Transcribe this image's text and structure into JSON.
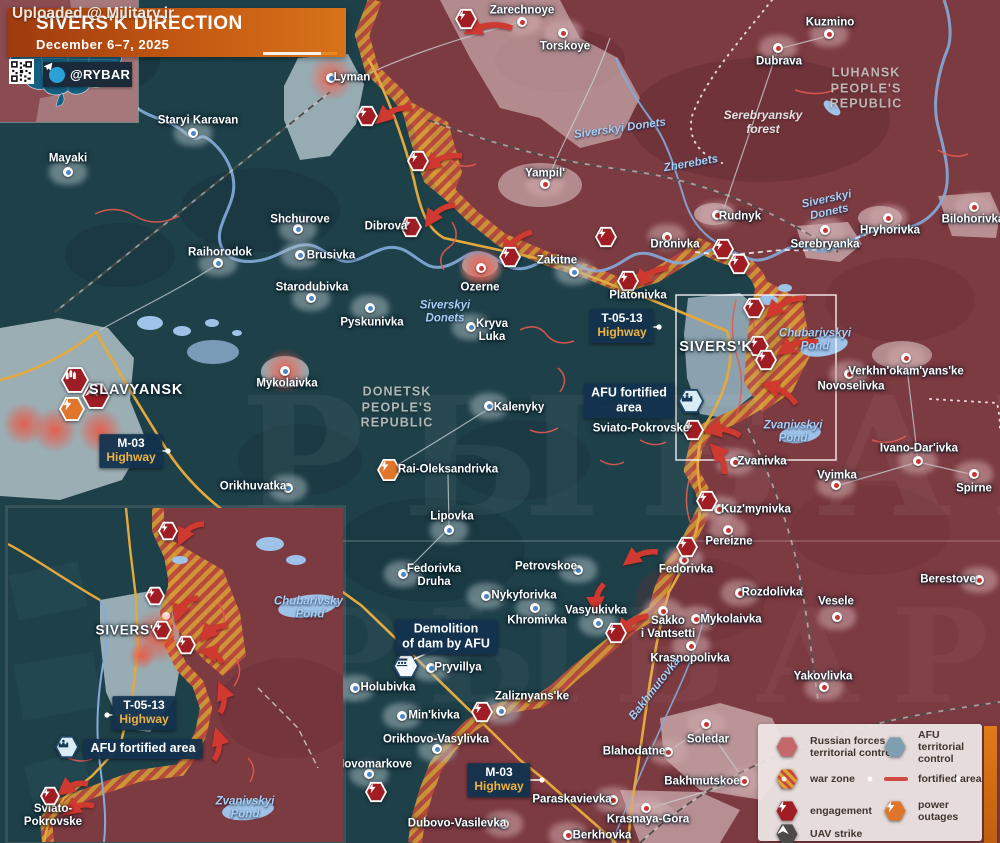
{
  "watermark_top": "Uploaded @ Military.ir",
  "big_watermark": "РЫБАРЬ",
  "header": {
    "title": "SIVERS'K DIRECTION",
    "date": "December 6–7, 2025",
    "channel": "@RYBAR"
  },
  "colors": {
    "banner_orange": "#c55a12",
    "navy_box": "#12314e",
    "engagement_red": "#a01d24",
    "power_orange": "#e0762b",
    "uav_gray": "#4d4a47",
    "russian_zone": "#7c3a41",
    "afu_zone": "#1e4049",
    "warzone_orange": "#d69a35",
    "warzone_red": "#bc4b3d",
    "telegram_blue": "#2aa2d8",
    "road_yellow": "#e3a93d",
    "river_blue": "#84abdb",
    "fortified_line": "#e4594e",
    "highway_text_yellow": "#efb23e"
  },
  "region_labels": [
    {
      "t": "LUHANSK\nPEOPLE'S\nREPUBLIC",
      "x": 866,
      "y": 89
    },
    {
      "t": "DONETSK\nPEOPLE'S\nREPUBLIC",
      "x": 397,
      "y": 408
    }
  ],
  "forest_labels": [
    {
      "t": "Serebryansky\nforest",
      "x": 763,
      "y": 123
    }
  ],
  "water_labels": [
    {
      "t": "Siverskyi Donets",
      "x": 620,
      "y": 129,
      "rot": -8
    },
    {
      "t": "Zherebets",
      "x": 691,
      "y": 164,
      "rot": -10
    },
    {
      "t": "Siverskyi\nDonets",
      "x": 828,
      "y": 206,
      "rot": -12
    },
    {
      "t": "Siverskyi\nDonets",
      "x": 445,
      "y": 312,
      "rot": 0
    },
    {
      "t": "Chubarivskyi\nPond",
      "x": 815,
      "y": 340,
      "rot": 0
    },
    {
      "t": "Zvanivskyi\nPond",
      "x": 793,
      "y": 432,
      "rot": 0
    },
    {
      "t": "Bakhmutovka",
      "x": 655,
      "y": 689,
      "rot": -52
    }
  ],
  "main_map": {
    "towns": [
      {
        "n": "Lyman",
        "lx": 352,
        "ly": 78,
        "dx": 331,
        "dy": 78,
        "z": "ua",
        "glow": true
      },
      {
        "n": "Zarechnoye",
        "lx": 522,
        "ly": 11,
        "dx": 522,
        "dy": 22,
        "z": "ru"
      },
      {
        "n": "Torskoye",
        "lx": 565,
        "ly": 47,
        "dx": 563,
        "dy": 33,
        "z": "ru"
      },
      {
        "n": "Kuzmino",
        "lx": 830,
        "ly": 23,
        "dx": 829,
        "dy": 34,
        "z": "ru"
      },
      {
        "n": "Dubrava",
        "lx": 779,
        "ly": 62,
        "dx": 778,
        "dy": 48,
        "z": "ru"
      },
      {
        "n": "Yampil'",
        "lx": 545,
        "ly": 174,
        "dx": 545,
        "dy": 184,
        "z": "ru"
      },
      {
        "n": "Rudnyk",
        "lx": 740,
        "ly": 217,
        "dx": 717,
        "dy": 215,
        "z": "ru"
      },
      {
        "n": "Serebryanka",
        "lx": 825,
        "ly": 245,
        "dx": 825,
        "dy": 230,
        "z": "ru"
      },
      {
        "n": "Hryhorivka",
        "lx": 890,
        "ly": 231,
        "dx": 888,
        "dy": 218,
        "z": "ru"
      },
      {
        "n": "Bilohorivka",
        "lx": 973,
        "ly": 220,
        "dx": 974,
        "dy": 207,
        "z": "ru"
      },
      {
        "n": "Mayaki",
        "lx": 68,
        "ly": 159,
        "dx": 68,
        "dy": 172,
        "z": "ua"
      },
      {
        "n": "Staryi Karavan",
        "lx": 198,
        "ly": 121,
        "dx": 193,
        "dy": 133,
        "z": "ua"
      },
      {
        "n": "Shchurove",
        "lx": 300,
        "ly": 220,
        "dx": 298,
        "dy": 229,
        "z": "ua"
      },
      {
        "n": "Brusivka",
        "lx": 331,
        "ly": 256,
        "dx": 300,
        "dy": 255,
        "z": "ua"
      },
      {
        "n": "Raihorodok",
        "lx": 220,
        "ly": 253,
        "dx": 218,
        "dy": 263,
        "z": "ua"
      },
      {
        "n": "Starodubivka",
        "lx": 312,
        "ly": 288,
        "dx": 311,
        "dy": 298,
        "z": "ua"
      },
      {
        "n": "Pyskunivka",
        "lx": 372,
        "ly": 323,
        "dx": 370,
        "dy": 308,
        "z": "ua"
      },
      {
        "n": "Dibrova",
        "lx": 386,
        "ly": 227,
        "z": "ua"
      },
      {
        "n": "Ozerne",
        "lx": 480,
        "ly": 288,
        "dx": 481,
        "dy": 268,
        "z": "ru",
        "glow": true
      },
      {
        "n": "Zakitne",
        "lx": 557,
        "ly": 261,
        "dx": 574,
        "dy": 272,
        "z": "ua"
      },
      {
        "n": "Kryva\nLuka",
        "lx": 492,
        "ly": 331,
        "dx": 471,
        "dy": 327,
        "z": "ua"
      },
      {
        "n": "Mykolaivka",
        "lx": 287,
        "ly": 384,
        "dx": 285,
        "dy": 371,
        "z": "ua",
        "glow": true
      },
      {
        "n": "Orikhuvatka",
        "lx": 253,
        "ly": 487,
        "dx": 288,
        "dy": 488,
        "z": "ua"
      },
      {
        "n": "Dronivka",
        "lx": 675,
        "ly": 245,
        "dx": 667,
        "dy": 237,
        "z": "ru"
      },
      {
        "n": "Platonivka",
        "lx": 638,
        "ly": 296,
        "z": "ru"
      },
      {
        "n": "SIVERS'K",
        "lx": 716,
        "ly": 347,
        "z": "ua",
        "big": true
      },
      {
        "n": "Sviato-Pokrovske",
        "lx": 641,
        "ly": 429,
        "z": "ua"
      },
      {
        "n": "Novoselivka",
        "lx": 851,
        "ly": 387,
        "dx": 849,
        "dy": 374,
        "z": "ru"
      },
      {
        "n": "Verkhn'okam'yans'ke",
        "lx": 906,
        "ly": 372,
        "dx": 906,
        "dy": 358,
        "z": "ru"
      },
      {
        "n": "Ivano-Dar'ivka",
        "lx": 919,
        "ly": 449,
        "dx": 918,
        "dy": 461,
        "z": "ru"
      },
      {
        "n": "Vyimka",
        "lx": 837,
        "ly": 476,
        "dx": 836,
        "dy": 485,
        "z": "ru"
      },
      {
        "n": "Spirne",
        "lx": 974,
        "ly": 489,
        "dx": 974,
        "dy": 474,
        "z": "ru"
      },
      {
        "n": "Berestove",
        "lx": 948,
        "ly": 580,
        "dx": 979,
        "dy": 580,
        "z": "ru"
      },
      {
        "n": "Vesele",
        "lx": 836,
        "ly": 602,
        "dx": 837,
        "dy": 617,
        "z": "ru"
      },
      {
        "n": "Zvanivka",
        "lx": 762,
        "ly": 462,
        "dx": 735,
        "dy": 462,
        "z": "ru"
      },
      {
        "n": "Kuz'mynivka",
        "lx": 756,
        "ly": 510,
        "dx": 719,
        "dy": 509,
        "z": "ru"
      },
      {
        "n": "Pereizne",
        "lx": 729,
        "ly": 542,
        "dx": 728,
        "dy": 530,
        "z": "ru"
      },
      {
        "n": "Fedorivka",
        "lx": 686,
        "ly": 570,
        "dx": 684,
        "dy": 560,
        "z": "ru"
      },
      {
        "n": "Rozdolivka",
        "lx": 772,
        "ly": 593,
        "dx": 740,
        "dy": 593,
        "z": "ru"
      },
      {
        "n": "Sakko\ni Vantsetti",
        "lx": 668,
        "ly": 628,
        "dx": 663,
        "dy": 611,
        "z": "ru"
      },
      {
        "n": "Mykolaivka",
        "lx": 731,
        "ly": 620,
        "dx": 696,
        "dy": 619,
        "z": "ru"
      },
      {
        "n": "Krasnopolivka",
        "lx": 690,
        "ly": 659,
        "dx": 691,
        "dy": 646,
        "z": "ru"
      },
      {
        "n": "Yakovlivka",
        "lx": 823,
        "ly": 677,
        "dx": 824,
        "dy": 687,
        "z": "ru"
      },
      {
        "n": "Kalenyky",
        "lx": 519,
        "ly": 408,
        "dx": 489,
        "dy": 406,
        "z": "ua"
      },
      {
        "n": "Rai-Oleksandrivka",
        "lx": 448,
        "ly": 470,
        "z": "ua"
      },
      {
        "n": "Lipovka",
        "lx": 452,
        "ly": 517,
        "dx": 449,
        "dy": 530,
        "z": "ua"
      },
      {
        "n": "Fedorivka\nDruha",
        "lx": 434,
        "ly": 576,
        "dx": 403,
        "dy": 574,
        "z": "ua"
      },
      {
        "n": "Petrovskoe",
        "lx": 546,
        "ly": 567,
        "dx": 578,
        "dy": 570,
        "z": "ua"
      },
      {
        "n": "Nykyforivka",
        "lx": 524,
        "ly": 596,
        "dx": 486,
        "dy": 596,
        "z": "ua"
      },
      {
        "n": "Vasyukivka",
        "lx": 596,
        "ly": 611,
        "dx": 598,
        "dy": 623,
        "z": "ua"
      },
      {
        "n": "Khromivka",
        "lx": 537,
        "ly": 621,
        "dx": 535,
        "dy": 608,
        "z": "ua"
      },
      {
        "n": "Holubivka",
        "lx": 388,
        "ly": 688,
        "dx": 355,
        "dy": 688,
        "z": "ua"
      },
      {
        "n": "Pryvillya",
        "lx": 458,
        "ly": 668,
        "dx": 431,
        "dy": 668,
        "z": "ua"
      },
      {
        "n": "Min'kivka",
        "lx": 434,
        "ly": 716,
        "dx": 402,
        "dy": 716,
        "z": "ua"
      },
      {
        "n": "Orikhovo-Vasylivka",
        "lx": 436,
        "ly": 740,
        "dx": 437,
        "dy": 749,
        "z": "ua"
      },
      {
        "n": "Novomarkove",
        "lx": 374,
        "ly": 765,
        "dx": 369,
        "dy": 774,
        "z": "ua"
      },
      {
        "n": "Zaliznyans'ke",
        "lx": 532,
        "ly": 697,
        "dx": 501,
        "dy": 711,
        "z": "ua"
      },
      {
        "n": "Blahodatne",
        "lx": 634,
        "ly": 752,
        "dx": 668,
        "dy": 752,
        "z": "ru"
      },
      {
        "n": "Soledar",
        "lx": 708,
        "ly": 740,
        "dx": 706,
        "dy": 724,
        "z": "ru"
      },
      {
        "n": "Bakhmutskoe",
        "lx": 702,
        "ly": 782,
        "dx": 744,
        "dy": 781,
        "z": "ru"
      },
      {
        "n": "Paraskavievka",
        "lx": 572,
        "ly": 800,
        "dx": 613,
        "dy": 800,
        "z": "ru"
      },
      {
        "n": "Krasnaya-Gora",
        "lx": 648,
        "ly": 820,
        "dx": 646,
        "dy": 808,
        "z": "ru"
      },
      {
        "n": "Berkhovka",
        "lx": 602,
        "ly": 836,
        "dx": 568,
        "dy": 835,
        "z": "ru"
      },
      {
        "n": "Dubovo-Vasilevka",
        "lx": 457,
        "ly": 824,
        "dx": 504,
        "dy": 824,
        "z": "ru"
      },
      {
        "n": "SLAVYANSK",
        "lx": 136,
        "ly": 390,
        "z": "ua",
        "big": true
      }
    ],
    "glows": [
      {
        "x": 24,
        "y": 424,
        "s": 44
      },
      {
        "x": 55,
        "y": 430,
        "s": 46
      },
      {
        "x": 100,
        "y": 431,
        "s": 46
      }
    ],
    "icons": [
      {
        "t": "missile-strike",
        "x": 75,
        "y": 380,
        "s": 28
      },
      {
        "t": "air-strike",
        "x": 96,
        "y": 396,
        "s": 28
      },
      {
        "t": "power-outage",
        "x": 72,
        "y": 409,
        "s": 26
      },
      {
        "t": "power-outage",
        "x": 389,
        "y": 470,
        "s": 24
      },
      {
        "t": "engagement",
        "x": 466,
        "y": 19,
        "s": 22
      },
      {
        "t": "engagement",
        "x": 367,
        "y": 116,
        "s": 22
      },
      {
        "t": "engagement",
        "x": 418,
        "y": 161,
        "s": 22
      },
      {
        "t": "engagement",
        "x": 411,
        "y": 227,
        "s": 22
      },
      {
        "t": "engagement",
        "x": 510,
        "y": 257,
        "s": 22
      },
      {
        "t": "engagement",
        "x": 606,
        "y": 237,
        "s": 22
      },
      {
        "t": "engagement",
        "x": 723,
        "y": 249,
        "s": 22
      },
      {
        "t": "engagement",
        "x": 739,
        "y": 264,
        "s": 22
      },
      {
        "t": "engagement",
        "x": 628,
        "y": 281,
        "s": 22
      },
      {
        "t": "engagement",
        "x": 754,
        "y": 308,
        "s": 22
      },
      {
        "t": "engagement",
        "x": 758,
        "y": 346,
        "s": 22
      },
      {
        "t": "engagement",
        "x": 766,
        "y": 360,
        "s": 22
      },
      {
        "t": "engagement",
        "x": 693,
        "y": 430,
        "s": 22
      },
      {
        "t": "engagement",
        "x": 707,
        "y": 501,
        "s": 22
      },
      {
        "t": "engagement",
        "x": 687,
        "y": 547,
        "s": 22
      },
      {
        "t": "engagement",
        "x": 616,
        "y": 633,
        "s": 22
      },
      {
        "t": "engagement",
        "x": 482,
        "y": 712,
        "s": 22
      },
      {
        "t": "engagement",
        "x": 376,
        "y": 792,
        "s": 22
      },
      {
        "t": "afu-fort",
        "x": 691,
        "y": 401,
        "s": 26
      },
      {
        "t": "dam",
        "x": 406,
        "y": 666,
        "s": 26
      }
    ],
    "attack_arrows": [
      {
        "x1": 512,
        "y1": 28,
        "x2": 472,
        "y2": 30,
        "b": 8
      },
      {
        "x1": 412,
        "y1": 108,
        "x2": 382,
        "y2": 118,
        "b": 7
      },
      {
        "x1": 462,
        "y1": 156,
        "x2": 430,
        "y2": 165,
        "b": 7
      },
      {
        "x1": 455,
        "y1": 205,
        "x2": 430,
        "y2": 220,
        "b": 7
      },
      {
        "x1": 532,
        "y1": 232,
        "x2": 507,
        "y2": 250,
        "b": 6
      },
      {
        "x1": 668,
        "y1": 268,
        "x2": 640,
        "y2": 281,
        "b": 6
      },
      {
        "x1": 806,
        "y1": 298,
        "x2": 772,
        "y2": 312,
        "b": 8
      },
      {
        "x1": 818,
        "y1": 342,
        "x2": 784,
        "y2": 350,
        "b": 7
      },
      {
        "x1": 796,
        "y1": 404,
        "x2": 770,
        "y2": 386,
        "b": 6
      },
      {
        "x1": 740,
        "y1": 436,
        "x2": 712,
        "y2": 430,
        "b": 6
      },
      {
        "x1": 724,
        "y1": 474,
        "x2": 716,
        "y2": 450,
        "b": 6
      },
      {
        "x1": 658,
        "y1": 552,
        "x2": 630,
        "y2": 560,
        "b": 6
      },
      {
        "x1": 604,
        "y1": 584,
        "x2": 596,
        "y2": 606,
        "b": 5
      },
      {
        "x1": 648,
        "y1": 616,
        "x2": 622,
        "y2": 630,
        "b": 5
      }
    ],
    "highway_callouts": [
      {
        "l1": "M-03",
        "l2": "Highway",
        "x": 131,
        "y": 451,
        "tx": 168,
        "ty": 451
      },
      {
        "l1": "T-05-13",
        "l2": "Highway",
        "x": 622,
        "y": 326,
        "tx": 659,
        "ty": 327
      },
      {
        "l1": "M-03",
        "l2": "Highway",
        "x": 499,
        "y": 780,
        "tx": 542,
        "ty": 780
      }
    ],
    "info_callouts": [
      {
        "t": "AFU fortified\narea",
        "x": 629,
        "y": 401
      },
      {
        "t": "Demolition\nof dam by AFU",
        "x": 446,
        "y": 637,
        "conn": [
          437,
          649,
          414,
          659
        ]
      }
    ]
  },
  "inset": {
    "labels": [
      {
        "n": "SIVERS'K",
        "lx": 122,
        "ly": 122,
        "big": true
      },
      {
        "n": "Sviato-\nPokrovske",
        "lx": 45,
        "ly": 308
      }
    ],
    "water_labels": [
      {
        "t": "Chubarivskyi\nPond",
        "x": 302,
        "y": 100
      },
      {
        "t": "Zvanivskyi\nPond",
        "x": 237,
        "y": 300
      }
    ],
    "icons": [
      {
        "t": "engagement",
        "x": 160,
        "y": 23,
        "s": 20
      },
      {
        "t": "engagement",
        "x": 147,
        "y": 88,
        "s": 20
      },
      {
        "t": "engagement",
        "x": 154,
        "y": 122,
        "s": 20
      },
      {
        "t": "engagement",
        "x": 178,
        "y": 137,
        "s": 20
      },
      {
        "t": "engagement",
        "x": 42,
        "y": 288,
        "s": 20
      },
      {
        "t": "afu-fort",
        "x": 59,
        "y": 239,
        "s": 24
      }
    ],
    "attack_arrows": [
      {
        "x1": 196,
        "y1": 16,
        "x2": 174,
        "y2": 30,
        "b": 8
      },
      {
        "x1": 190,
        "y1": 90,
        "x2": 170,
        "y2": 106,
        "b": 8
      },
      {
        "x1": 220,
        "y1": 118,
        "x2": 198,
        "y2": 127,
        "b": 6
      },
      {
        "x1": 214,
        "y1": 155,
        "x2": 200,
        "y2": 144,
        "b": 5
      },
      {
        "x1": 212,
        "y1": 205,
        "x2": 214,
        "y2": 182,
        "b": 6
      },
      {
        "x1": 206,
        "y1": 252,
        "x2": 210,
        "y2": 228,
        "b": 6
      },
      {
        "x1": 80,
        "y1": 276,
        "x2": 56,
        "y2": 282,
        "b": 6
      },
      {
        "x1": 86,
        "y1": 298,
        "x2": 62,
        "y2": 302,
        "b": 6
      }
    ],
    "highway_callouts": [
      {
        "l1": "T-05-13",
        "l2": "Highway",
        "x": 136,
        "y": 205,
        "tx": 99,
        "ty": 207
      }
    ],
    "info_callouts": [
      {
        "t": "AFU fortified area",
        "x": 135,
        "y": 241,
        "conn": [
          104,
          241,
          82,
          240
        ]
      }
    ],
    "glows": [
      {
        "x": 150,
        "y": 128,
        "s": 56
      },
      {
        "x": 134,
        "y": 148,
        "s": 28
      }
    ]
  },
  "legend": {
    "items": [
      {
        "x": 787,
        "y": 747,
        "icon": "russian",
        "label": "Russian forces\nterritorial control"
      },
      {
        "x": 895,
        "y": 747,
        "icon": "afu",
        "label": "AFU territorial control"
      },
      {
        "x": 787,
        "y": 779,
        "icon": "warzone",
        "label": "war zone"
      },
      {
        "x": 895,
        "y": 779,
        "icon": "fortline",
        "label": "fortified area"
      },
      {
        "x": 787,
        "y": 811,
        "icon": "engagement",
        "label": "engagement"
      },
      {
        "x": 895,
        "y": 811,
        "icon": "power",
        "label": "power outages"
      },
      {
        "x": 787,
        "y": 834,
        "icon": "uav",
        "label": "UAV strike"
      }
    ]
  }
}
